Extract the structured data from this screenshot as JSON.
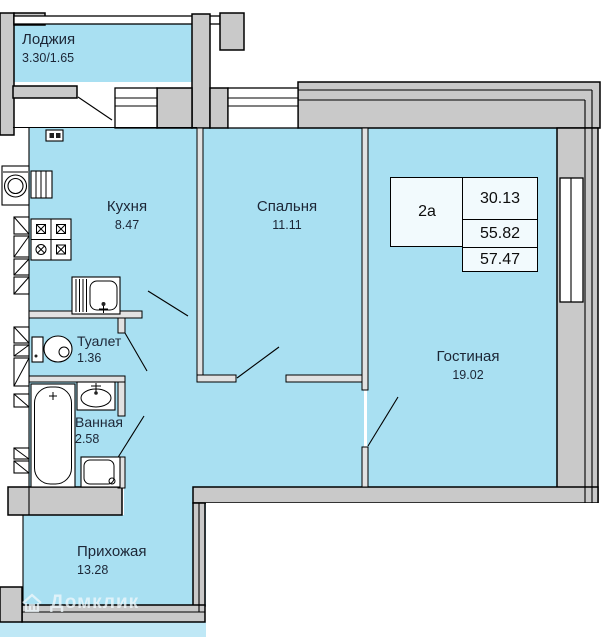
{
  "plan": {
    "rooms": [
      {
        "name": "Лоджия",
        "area": "3.30/1.65"
      },
      {
        "name": "Кухня",
        "area": "8.47"
      },
      {
        "name": "Спальня",
        "area": "11.11"
      },
      {
        "name": "Гостиная",
        "area": "19.02"
      },
      {
        "name": "Туалет",
        "area": "1.36"
      },
      {
        "name": "Ванная",
        "area": "2.58"
      },
      {
        "name": "Прихожая",
        "area": "13.28"
      }
    ],
    "info_table": {
      "unit": "2а",
      "living_area": "30.13",
      "apartment_area": "55.82",
      "total_area": "57.47"
    },
    "watermark": "Домклик",
    "colors": {
      "room_fill": "#a9e0f2",
      "strip_fill": "#bfe8f6",
      "wall_fill": "#c9c9c9",
      "outline": "#000000",
      "label_color": "#1c2636"
    }
  }
}
